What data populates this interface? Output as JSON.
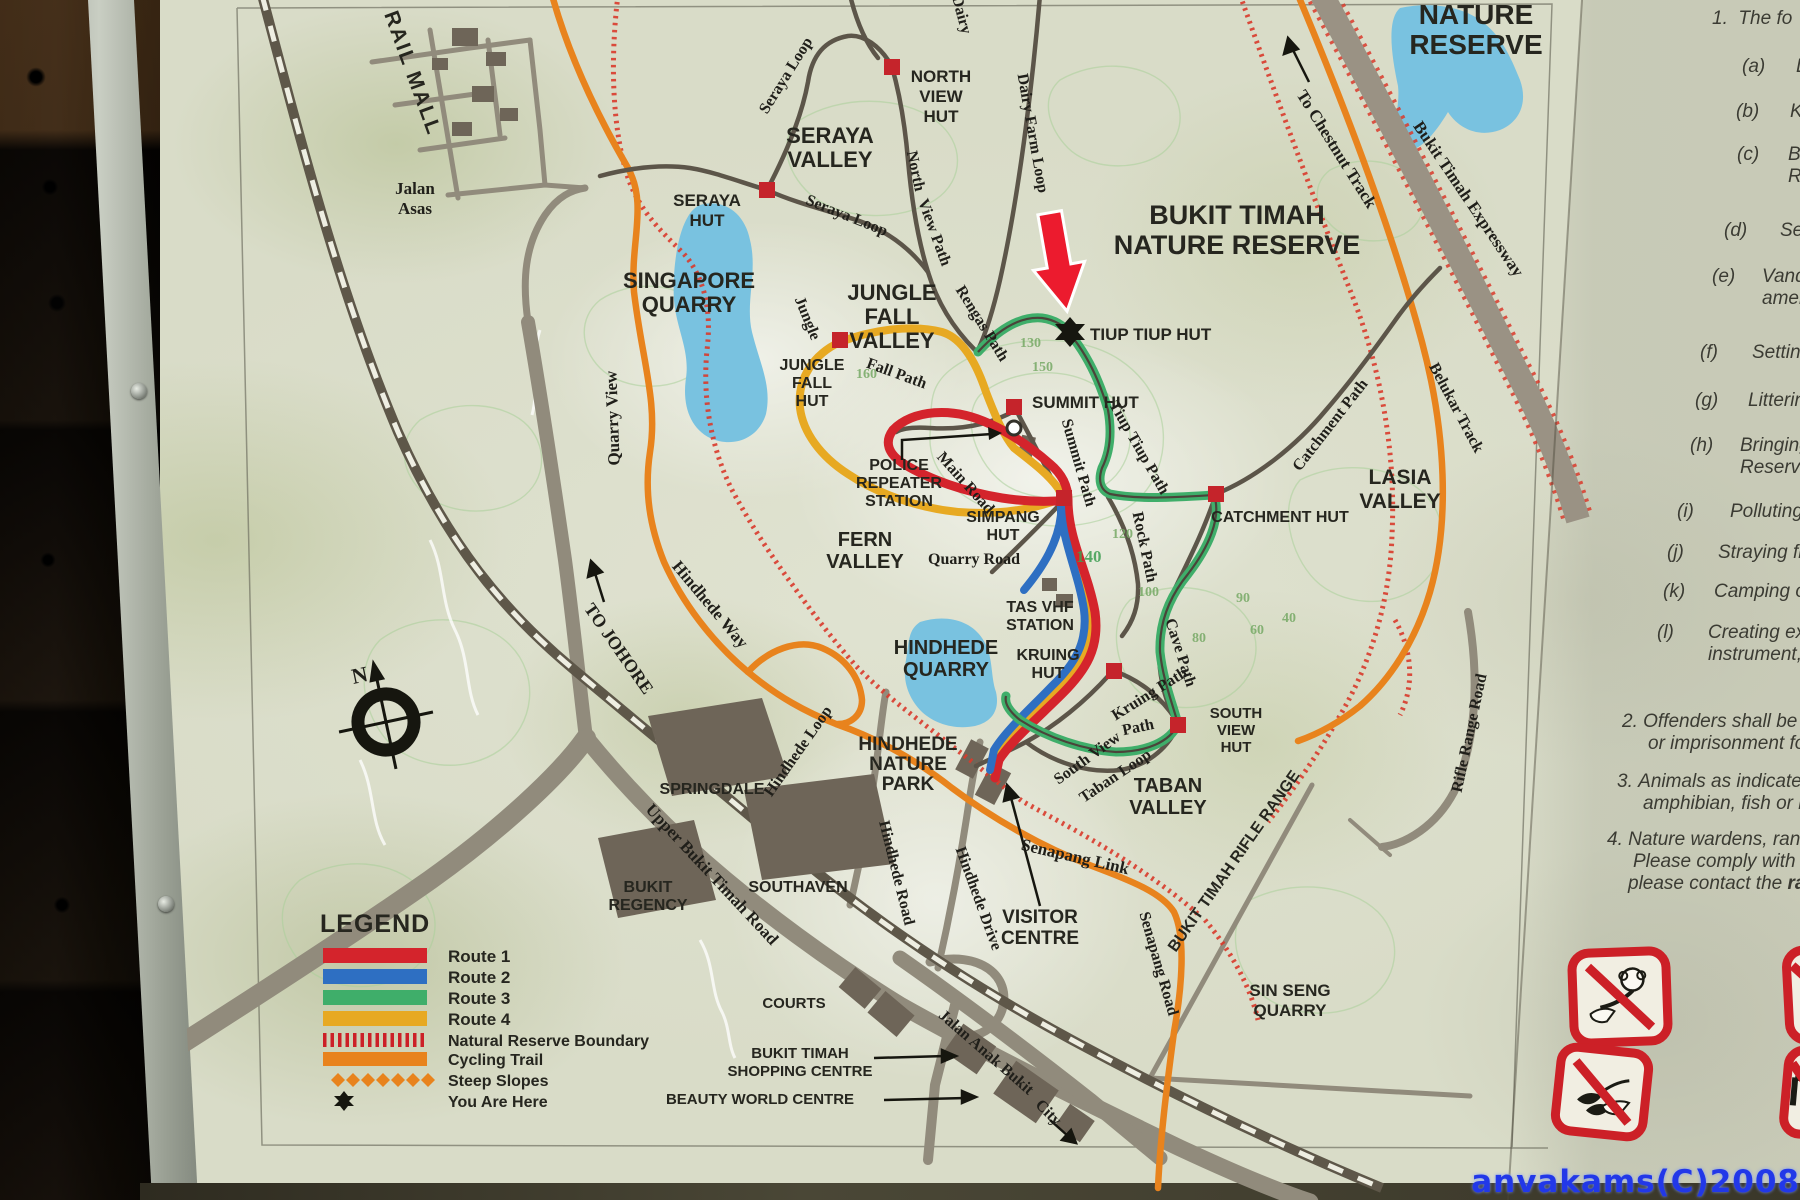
{
  "map": {
    "labels": {
      "rail_mall": "RAIL MALL",
      "jalan_asas_1": "Jalan",
      "jalan_asas_2": "Asas",
      "seraya_hut_1": "SERAYA",
      "seraya_hut_2": "HUT",
      "singapore_quarry_1": "SINGAPORE",
      "singapore_quarry_2": "QUARRY",
      "seraya_valley_1": "SERAYA",
      "seraya_valley_2": "VALLEY",
      "north_view_hut_1": "NORTH",
      "north_view_hut_2": "VIEW",
      "north_view_hut_3": "HUT",
      "seraya_loop_top": "Seraya Loop",
      "seraya_loop_lower": "Seraya Loop",
      "dairy_partial": "Dairy",
      "dairy_farm_loop": "Dairy Farm Loop",
      "north_word": "North",
      "view_path_word": "View Path",
      "jungle_fall_valley_1": "JUNGLE",
      "jungle_fall_valley_2": "FALL",
      "jungle_fall_valley_3": "VALLEY",
      "jungle_word": "Jungle",
      "jungle_fall_hut_1": "JUNGLE",
      "jungle_fall_hut_2": "FALL",
      "jungle_fall_hut_3": "HUT",
      "fall_path": "Fall Path",
      "rengas_path": "Rengas Path",
      "nature_reserve_top_1": "NATURE",
      "nature_reserve_top_2": "RESERVE",
      "to_chestnut_track": "To Chestnut Track",
      "bukit_timah_expressway": "Bukit Timah Expressway",
      "belukar_track": "Belukar Track",
      "btnr_title_1": "BUKIT TIMAH",
      "btnr_title_2": "NATURE RESERVE",
      "tiup_tiup_hut": "TIUP TIUP HUT",
      "summit_hut": "SUMMIT HUT",
      "summit_path": "Summit Path",
      "tiup_tiup_path": "Tiup Tiup Path",
      "police_1": "POLICE",
      "police_2": "REPEATER",
      "police_3": "STATION",
      "main_road": "Main Road",
      "simpang_hut_1": "SIMPANG",
      "simpang_hut_2": "HUT",
      "quarry_road": "Quarry Road",
      "fern_valley_1": "FERN",
      "fern_valley_2": "VALLEY",
      "rock_path": "Rock Path",
      "catchment_hut": "CATCHMENT HUT",
      "catchment_path": "Catchment Path",
      "lasia_valley_1": "LASIA",
      "lasia_valley_2": "VALLEY",
      "tas_vhf_1": "TAS VHF",
      "tas_vhf_2": "STATION",
      "hindhede_quarry_1": "HINDHEDE",
      "hindhede_quarry_2": "QUARRY",
      "kruing_hut_1": "KRUING",
      "kruing_hut_2": "HUT",
      "cave_path": "Cave Path",
      "kruing_path": "Kruing Path",
      "path_word": "Path",
      "south_view_word": "South View",
      "taban_loop": "Taban Loop",
      "south_view_hut_1": "SOUTH",
      "south_view_hut_2": "VIEW",
      "south_view_hut_3": "HUT",
      "taban_valley_1": "TABAN",
      "taban_valley_2": "VALLEY",
      "hindhede_nature_park_1": "HINDHEDE",
      "hindhede_nature_park_2": "NATURE",
      "hindhede_nature_park_3": "PARK",
      "hindhede_loop": "Hindhede Loop",
      "hindhede_way": "Hindhede Way",
      "quarry_view": "Quarry View",
      "to_johore": "TO JOHORE",
      "compass_n": "N",
      "springdale": "SPRINGDALE",
      "upper_bukit_timah_road": "Upper Bukit Timah Road",
      "bukit_regency_1": "BUKIT",
      "bukit_regency_2": "REGENCY",
      "southaven": "SOUTHAVEN",
      "hindhede_road": "Hindhede Road",
      "hindhede_drive": "Hindhede Drive",
      "visitor_centre_1": "VISITOR",
      "visitor_centre_2": "CENTRE",
      "courts": "COURTS",
      "bt_shopping_1": "BUKIT TIMAH",
      "bt_shopping_2": "SHOPPING CENTRE",
      "beauty_world": "BEAUTY WORLD CENTRE",
      "jalan_anak_bukit": "Jalan Anak Bukit",
      "city": "City",
      "senapang_link": "Senapang Link",
      "senapang_road": "Senapang Road",
      "bt_rifle_range": "BUKIT TIMAH RIFLE RANGE",
      "sin_seng_quarry_1": "SIN SENG",
      "sin_seng_quarry_2": "QUARRY",
      "rifle_range_road": "Rifle Range Road"
    },
    "contours": [
      "160",
      "150",
      "130",
      "140",
      "120",
      "100",
      "90",
      "80",
      "60",
      "40"
    ],
    "colors": {
      "route1": "#d4242c",
      "route2": "#2e6fc2",
      "route3": "#3fae6a",
      "route4": "#e7a922",
      "cycling_trail": "#e8831d",
      "boundary": "#d93a2b",
      "lake": "#79c2e0",
      "road": "#918b7c",
      "railway": "#6a6354",
      "marker_red": "#c5242b"
    }
  },
  "legend": {
    "title": "LEGEND",
    "items": [
      {
        "label": "Route 1",
        "color": "#d4242c",
        "type": "bar"
      },
      {
        "label": "Route 2",
        "color": "#2e6fc2",
        "type": "bar"
      },
      {
        "label": "Route 3",
        "color": "#3fae6a",
        "type": "bar"
      },
      {
        "label": "Route 4",
        "color": "#e7a922",
        "type": "bar"
      },
      {
        "label": "Natural Reserve Boundary",
        "color": "#d93a2b",
        "type": "hatch"
      },
      {
        "label": "Cycling Trail",
        "color": "#e8831d",
        "type": "bar"
      },
      {
        "label": "Steep Slopes",
        "color": "#e8831d",
        "type": "diamonds"
      },
      {
        "label": "You Are Here",
        "color": "#16160f",
        "type": "star"
      }
    ]
  },
  "rules": {
    "intro_num": "1.",
    "intro_text": "The fo",
    "items": [
      {
        "label": "(a)",
        "lines": [
          "L"
        ]
      },
      {
        "label": "(b)",
        "lines": [
          "K"
        ]
      },
      {
        "label": "(c)",
        "lines": [
          "Br",
          "Re"
        ]
      },
      {
        "label": "(d)",
        "lines": [
          "Set"
        ]
      },
      {
        "label": "(e)",
        "lines": [
          "Vand",
          "amen"
        ]
      },
      {
        "label": "(f)",
        "lines": [
          "Setting"
        ]
      },
      {
        "label": "(g)",
        "lines": [
          "Littering"
        ]
      },
      {
        "label": "(h)",
        "lines": [
          "Bringing",
          "Reserve"
        ]
      },
      {
        "label": "(i)",
        "lines": [
          "Polluting,"
        ]
      },
      {
        "label": "(j)",
        "lines": [
          "Straying fr"
        ]
      },
      {
        "label": "(k)",
        "lines": [
          "Camping or"
        ]
      },
      {
        "label": "(l)",
        "lines": [
          "Creating exc",
          "instrument, lo"
        ]
      }
    ],
    "numbered": [
      {
        "label": "2.",
        "lines": [
          "Offenders shall be lia",
          "or imprisonment for a"
        ]
      },
      {
        "label": "3.",
        "lines": [
          "Animals as indicated",
          "amphibian, fish or inver"
        ]
      },
      {
        "label": "4.",
        "lines": [
          "Nature wardens, range",
          "Please comply with thei"
        ],
        "last_prefix": "please contact the ",
        "last_bold": "range"
      }
    ]
  },
  "watermark": "anvakams(C)2008"
}
